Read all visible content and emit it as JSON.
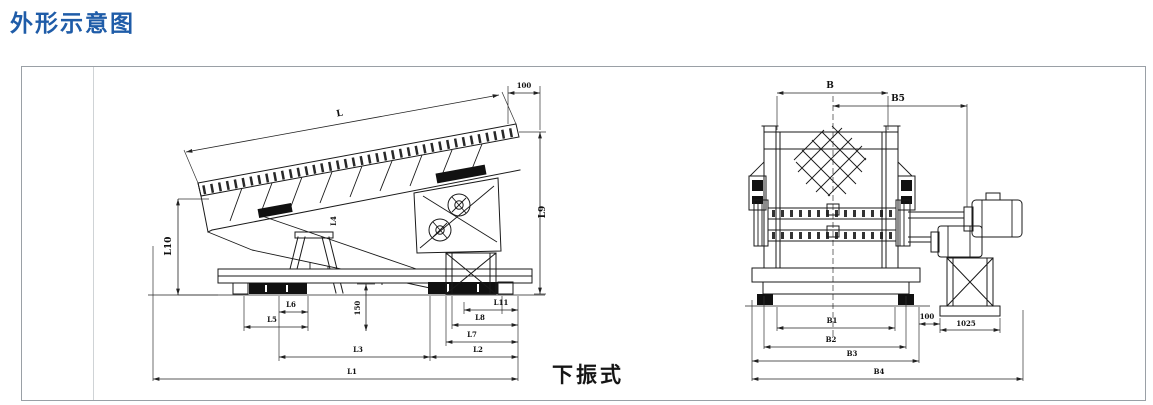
{
  "page": {
    "title": "外形示意图",
    "caption": "下振式"
  },
  "side_view": {
    "dim_labels": {
      "L": "L",
      "offset_top": "100",
      "L9": "L9",
      "L10": "L10",
      "L4": "L4",
      "height_150": "150",
      "L6": "L6",
      "L5": "L5",
      "L11": "L11",
      "L8": "L8",
      "L7": "L7",
      "L3": "L3",
      "L2": "L2",
      "L1": "L1"
    }
  },
  "front_view": {
    "dim_labels": {
      "B": "B",
      "B5": "B5",
      "B1": "B1",
      "B2": "B2",
      "B3": "B3",
      "B4": "B4",
      "gap_100": "100",
      "stand_1025": "1025"
    }
  }
}
